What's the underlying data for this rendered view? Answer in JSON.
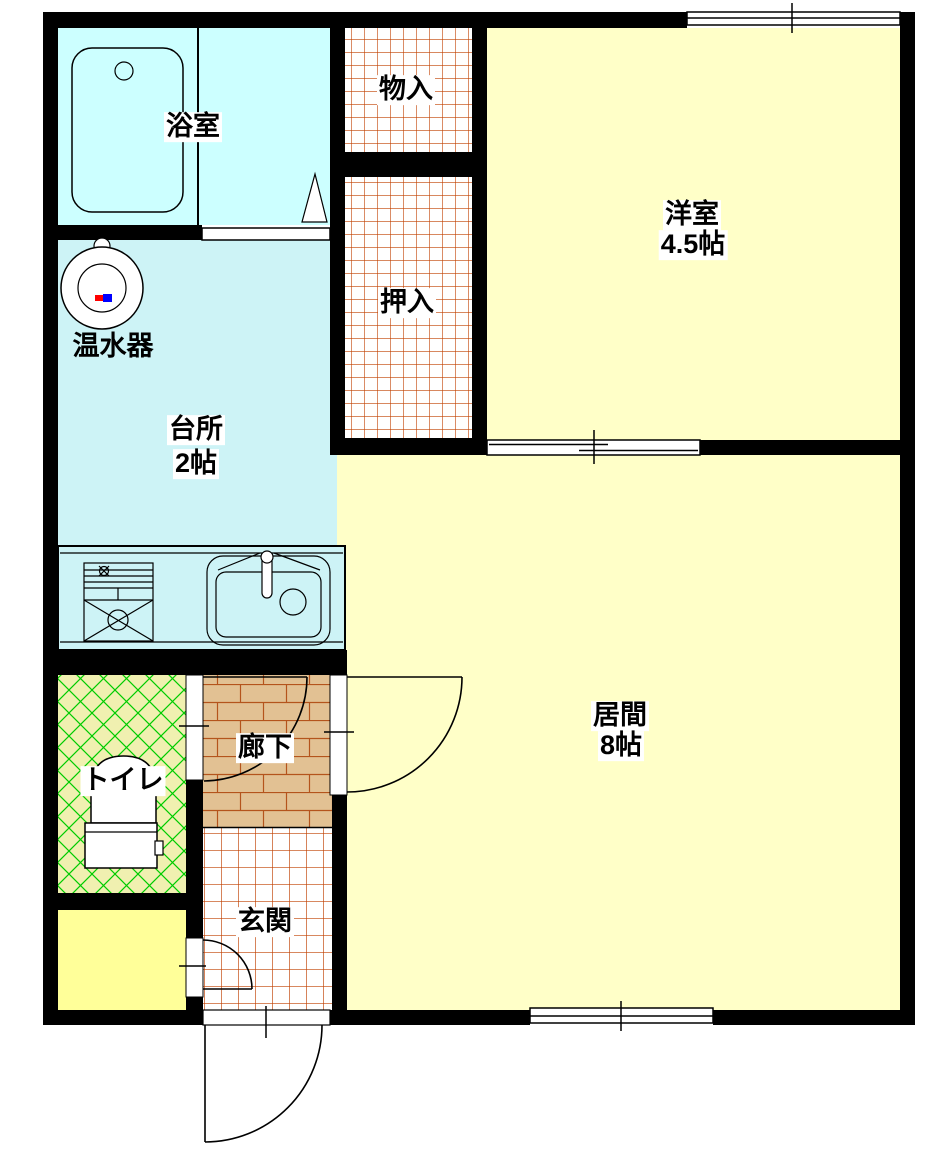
{
  "floorplan": {
    "type": "japanese-apartment-floor-plan",
    "rooms": [
      {
        "id": "bathroom",
        "label": "浴室"
      },
      {
        "id": "water-heater",
        "label": "温水器"
      },
      {
        "id": "kitchen",
        "label": "台所",
        "size": "2帖"
      },
      {
        "id": "storage",
        "label": "物入"
      },
      {
        "id": "closet",
        "label": "押入"
      },
      {
        "id": "western-room",
        "label": "洋室",
        "size": "4.5帖"
      },
      {
        "id": "living-room",
        "label": "居間",
        "size": "8帖"
      },
      {
        "id": "toilet",
        "label": "トイレ"
      },
      {
        "id": "corridor",
        "label": "廊下"
      },
      {
        "id": "entrance",
        "label": "玄関"
      }
    ],
    "fixtures": [
      "bathtub",
      "water-heater-unit",
      "kitchen-counter",
      "gas-stove",
      "sink",
      "toilet-bowl"
    ],
    "openings": [
      "top-window",
      "sliding-door-western-living",
      "bottom-window",
      "entrance-door",
      "toilet-door",
      "living-room-door",
      "storeroom-door",
      "bathroom-sliding-door"
    ],
    "colors": {
      "wall": "#000000",
      "bathroom": "#CCFFFF",
      "kitchen": "#CDF3F6",
      "tatami_room": "#FFFFC8",
      "small_room": "#FFFF99",
      "toilet_bg": "#F0F0B0",
      "toilet_lattice": "#00CC00",
      "corridor_bg": "#E2C193",
      "corridor_brick": "#B4541C",
      "tile_grid": "#C04000"
    }
  }
}
